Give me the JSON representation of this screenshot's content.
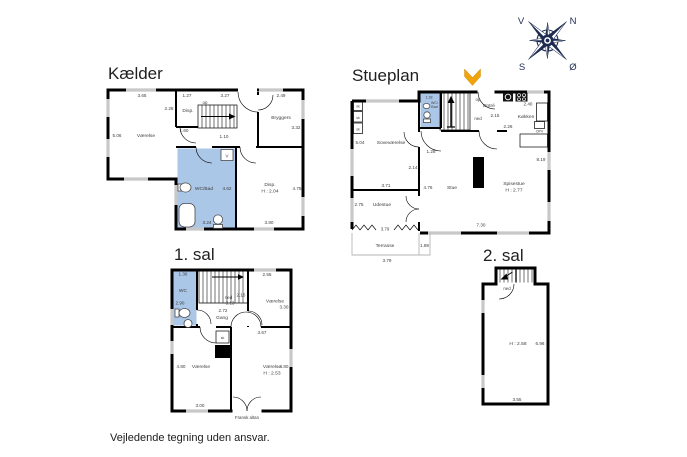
{
  "page": {
    "disclaimer": "Vejledende tegning uden ansvar."
  },
  "colors": {
    "highlight_room": "#abc7e8",
    "wall": "#000000",
    "window_mark": "#c8c8c8",
    "entry_arrow": "#f0a30a",
    "compass": "#1d2c50"
  },
  "compass": {
    "west": "V",
    "north": "N",
    "south": "S",
    "east": "Ø"
  },
  "floors": {
    "kaelder": {
      "title": "Kælder",
      "rooms": {
        "vaerelse": "Værelse",
        "disp": "Disp.",
        "bryggers": "Bryggers",
        "wc_bad": "WC/Bad",
        "disp2": "Disp.",
        "disp2_ceiling": "H : 2.04"
      },
      "stairs_op": "op",
      "washer": "V",
      "dims": {
        "vaerelse_w": "3.65",
        "disp_w": "1.27",
        "stairs_w": "3.27",
        "bryggers_w": "2.49",
        "disp_d": "2.28",
        "vaerelse_d": "5.06",
        "hall_1": "1.60",
        "hall_2": "1.10",
        "bryggers_d": "3.32",
        "wc_bad_d": "4.62",
        "wc_bad_w": "3.24",
        "disp2_d": "4.75",
        "disp2_w": "3.80"
      }
    },
    "stueplan": {
      "title": "Stueplan",
      "rooms": {
        "wc_line1": "WC/",
        "wc_line2": "Bad",
        "entre": "Entré",
        "kokken": "Køkken",
        "sovevaerelse": "Soveværelse",
        "stue": "Stue",
        "spisestue": "Spisestue",
        "spisestue_ceiling": "H : 2.77",
        "udestue": "Udestue",
        "terrasse": "Terrasse"
      },
      "stairs_op": "op",
      "stairs_ned": "ned",
      "closet": "sk",
      "dishwasher": "OPV",
      "dims": {
        "wc_w": "1.28",
        "entre_w": "2.15",
        "entre_d": "2.26",
        "kokken_w": "2.40",
        "sove_d": "5.04",
        "sove_w": "3.71",
        "hall_w": "1.28",
        "hall_d": "2.14",
        "stue_w": "4.76",
        "right_d": "8.19",
        "bottom_w": "7.30",
        "udestue_d": "2.75",
        "udestue_w": "3.79",
        "terrasse_w": "1.89",
        "terrasse_d": "3.79"
      }
    },
    "sal1": {
      "title": "1. sal",
      "rooms": {
        "wc": "WC",
        "gang": "Gang",
        "vaerelse_ne": "Værelse",
        "vaerelse_sw": "Værelse",
        "vaerelse_se": "Værelse",
        "vaerelse_se_ceiling": "H : 2.53",
        "fransk_altan": "Fransk altan"
      },
      "stairs_ned": "ned",
      "closet": "sk",
      "dims": {
        "wc_w": "1.36",
        "wc_d": "2.90",
        "stairs_w": "2.16",
        "stairs_len": "3.13",
        "gang_w": "2.72",
        "ne_w": "2.55",
        "ne_d": "3.30",
        "se_top_w": "3.67",
        "sw_d": "4.80",
        "sw_w": "3.00",
        "se_d": "4.80"
      }
    },
    "sal2": {
      "title": "2. sal",
      "stairs_ned": "ned",
      "dims": {
        "ceiling": "H : 2.58",
        "room_d": "6.96",
        "room_w": "3.55"
      }
    }
  }
}
